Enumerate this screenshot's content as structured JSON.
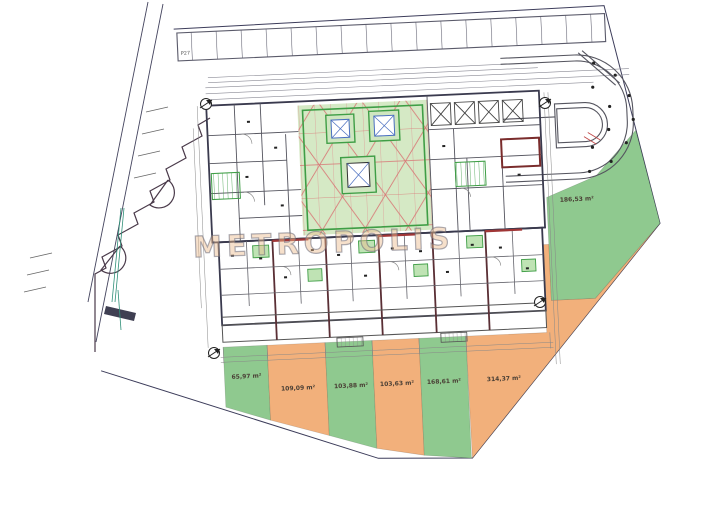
{
  "watermark_text": "METROPOLIS",
  "parking": {
    "label": "P27"
  },
  "garden_plots": [
    {
      "id": "plot-1",
      "color": "green",
      "label": "65,97 m²"
    },
    {
      "id": "plot-2",
      "color": "orange",
      "label": "109,09 m²"
    },
    {
      "id": "plot-3",
      "color": "green",
      "label": "103,88 m²"
    },
    {
      "id": "plot-4",
      "color": "orange",
      "label": "103,63 m²"
    },
    {
      "id": "plot-5",
      "color": "green",
      "label": "168,61 m²"
    },
    {
      "id": "plot-6",
      "color": "orange",
      "label": "314,37 m²"
    },
    {
      "id": "plot-7",
      "color": "green",
      "label": "186,53 m²"
    }
  ],
  "icons": {
    "entrance_marker": "circled-arrow",
    "north_arrow": "circled-arrow"
  },
  "colors": {
    "plot_green": "#8fc98f",
    "courtyard_green": "#d5e9c5",
    "plot_orange": "#f2b07b",
    "red_grid": "#d87474",
    "accent_green": "#3f9e46",
    "wall_dark": "#3a3a4e",
    "wall_red": "#a03636",
    "boundary": "#3c3c5a",
    "skylight_blue": "#4a6fc0",
    "utility_teal": "#2f8f78"
  }
}
